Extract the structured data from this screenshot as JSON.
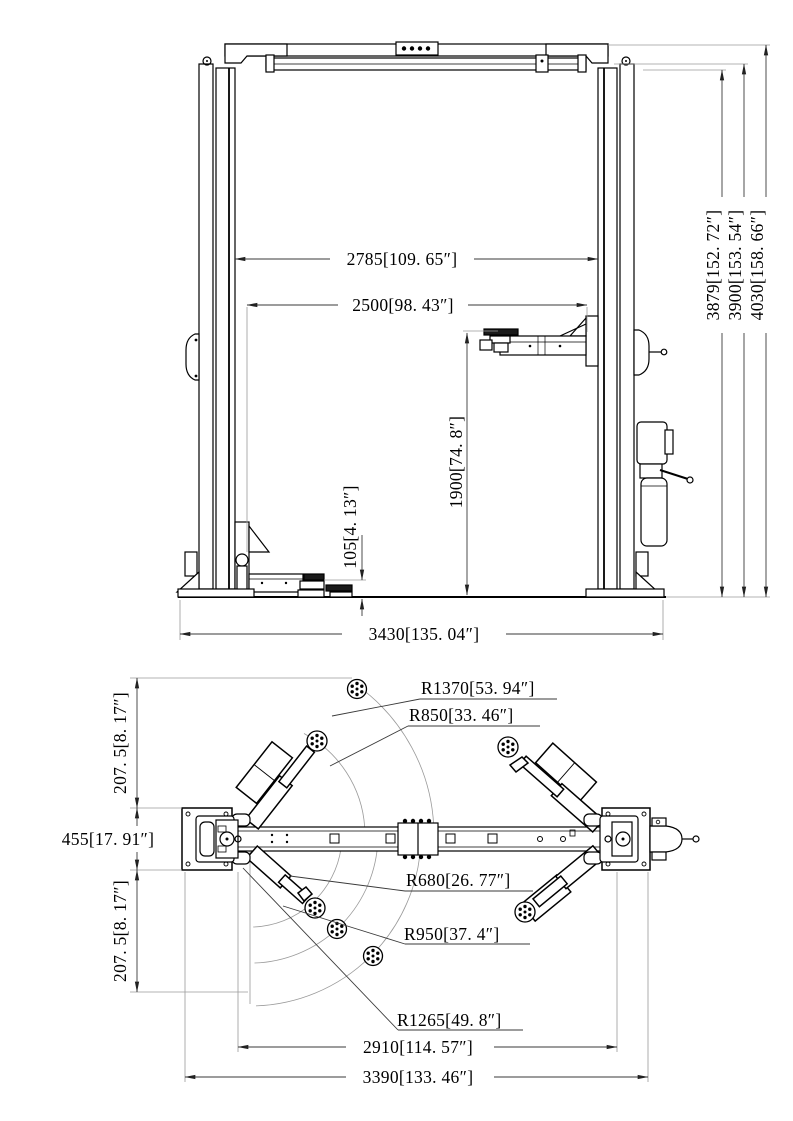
{
  "drawing": {
    "views": [
      "front-elevation",
      "plan-view"
    ],
    "colors": {
      "outline": "#000000",
      "dimension": "#3a3a3a",
      "light_line": "#9a9a9a"
    }
  },
  "front_view": {
    "span_inner": "2785[109. 65″]",
    "span_carriage": "2500[98. 43″]",
    "lift_height": "1900[74. 8″]",
    "pad_min_height": "105[4. 13″]",
    "base_width": "3430[135. 04″]",
    "clearance_height": "3879[152. 72″]",
    "column_height": "3900[153. 54″]",
    "overall_height": "4030[158. 66″]"
  },
  "plan_view": {
    "radius_max": "R1370[53. 94″]",
    "radius_front": "R850[33. 46″]",
    "radius_rear_min": "R680[26. 77″]",
    "radius_rear_mid": "R950[37. 4″]",
    "radius_rear_max": "R1265[49. 8″]",
    "span_inner": "2910[114. 57″]",
    "span_outer": "3390[133. 46″]",
    "offset_top": "207. 5[8. 17″]",
    "base_depth": "455[17. 91″]",
    "offset_bottom": "207. 5[8. 17″]"
  }
}
